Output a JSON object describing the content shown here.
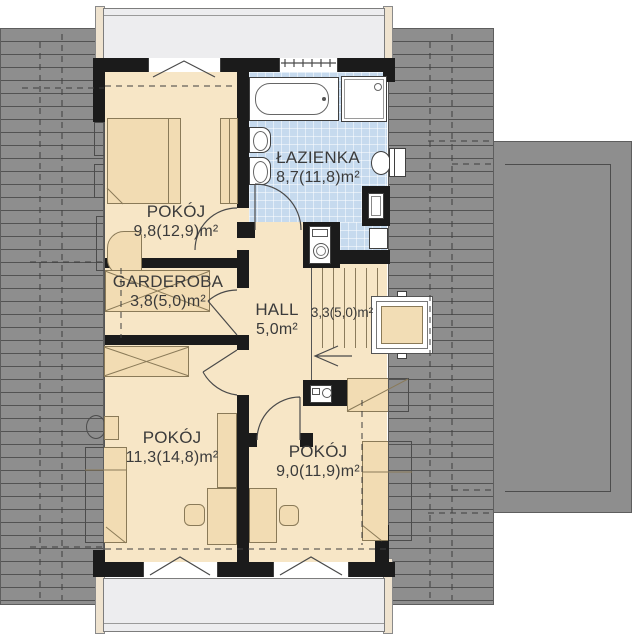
{
  "plan_title": "Attic floor plan",
  "rooms": {
    "bedroom1": {
      "name": "POKÓJ",
      "area": "9,8(12,9)m²"
    },
    "bathroom": {
      "name": "ŁAZIENKA",
      "area": "8,7(11,8)m²"
    },
    "garderoba": {
      "name": "GARDEROBA",
      "area": "3,8(5,0)m²"
    },
    "hall": {
      "name": "HALL",
      "area": "5,0m²"
    },
    "stairs": {
      "area": "3,3(5,0)m²"
    },
    "bedroom2": {
      "name": "POKÓJ",
      "area": "11,3(14,8)m²"
    },
    "bedroom3": {
      "name": "POKÓJ",
      "area": "9,0(11,9)m²"
    }
  },
  "colors": {
    "roof": "#8e8e8e",
    "floor": "#f7e6c6",
    "furniture": "#f2dcb3",
    "bathroom_tiles": "#c6daee",
    "walls": "#1b1b1b",
    "dormer": "#ededef",
    "text": "#3b3b3b"
  }
}
